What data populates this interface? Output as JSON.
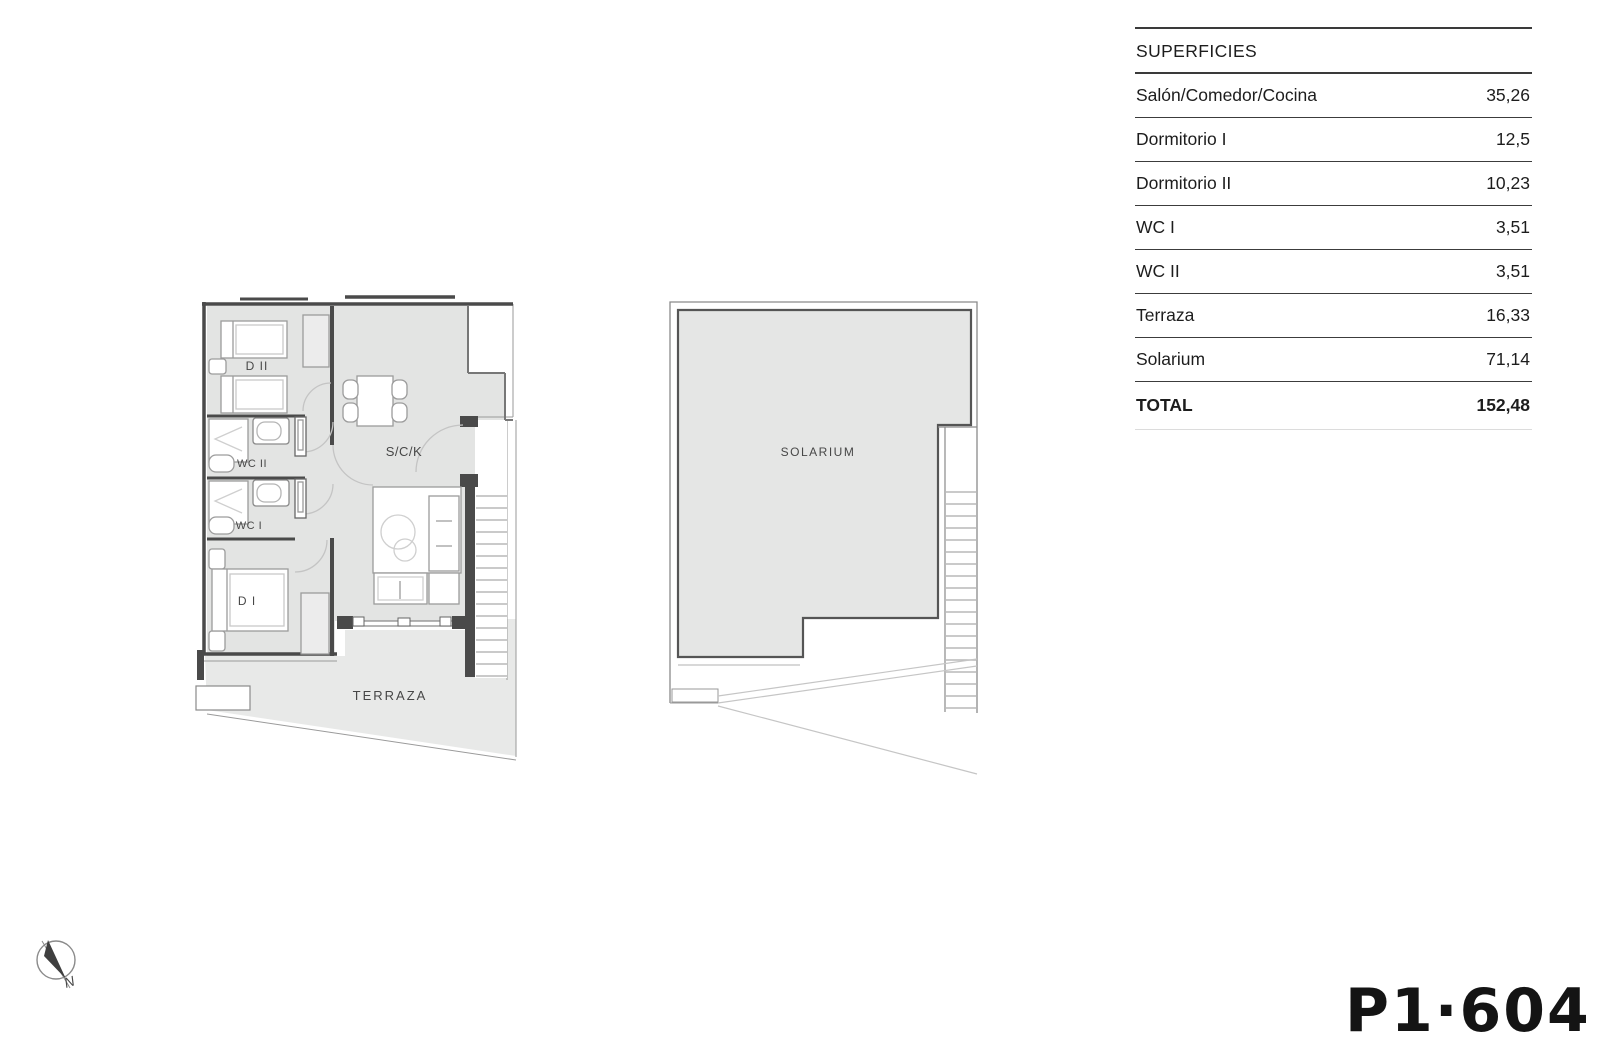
{
  "table": {
    "header": "SUPERFICIES",
    "rows": [
      {
        "label": "Salón/Comedor/Cocina",
        "value": "35,26"
      },
      {
        "label": "Dormitorio I",
        "value": "12,5"
      },
      {
        "label": "Dormitorio II",
        "value": "10,23"
      },
      {
        "label": "WC I",
        "value": "3,51"
      },
      {
        "label": "WC II",
        "value": "3,51"
      },
      {
        "label": "Terraza",
        "value": "16,33"
      },
      {
        "label": "Solarium",
        "value": "71,14"
      }
    ],
    "total": {
      "label": "TOTAL",
      "value": "152,48"
    }
  },
  "floorplan": {
    "labels": {
      "d2": "D II",
      "wc2": "WC II",
      "wc1": "WC I",
      "d1": "D I",
      "sck": "S/C/K",
      "terraza": "TERRAZA",
      "solarium": "SOLARIUM"
    },
    "compass": "N"
  },
  "sheet": {
    "code": "P1·604"
  },
  "colors": {
    "floor_fill": "#e3e4e3",
    "terrace_fill": "#e8e9e8",
    "solarium_fill": "#e5e6e5",
    "wall": "#4a4a4a",
    "table_rule": "#3a3a3a"
  }
}
